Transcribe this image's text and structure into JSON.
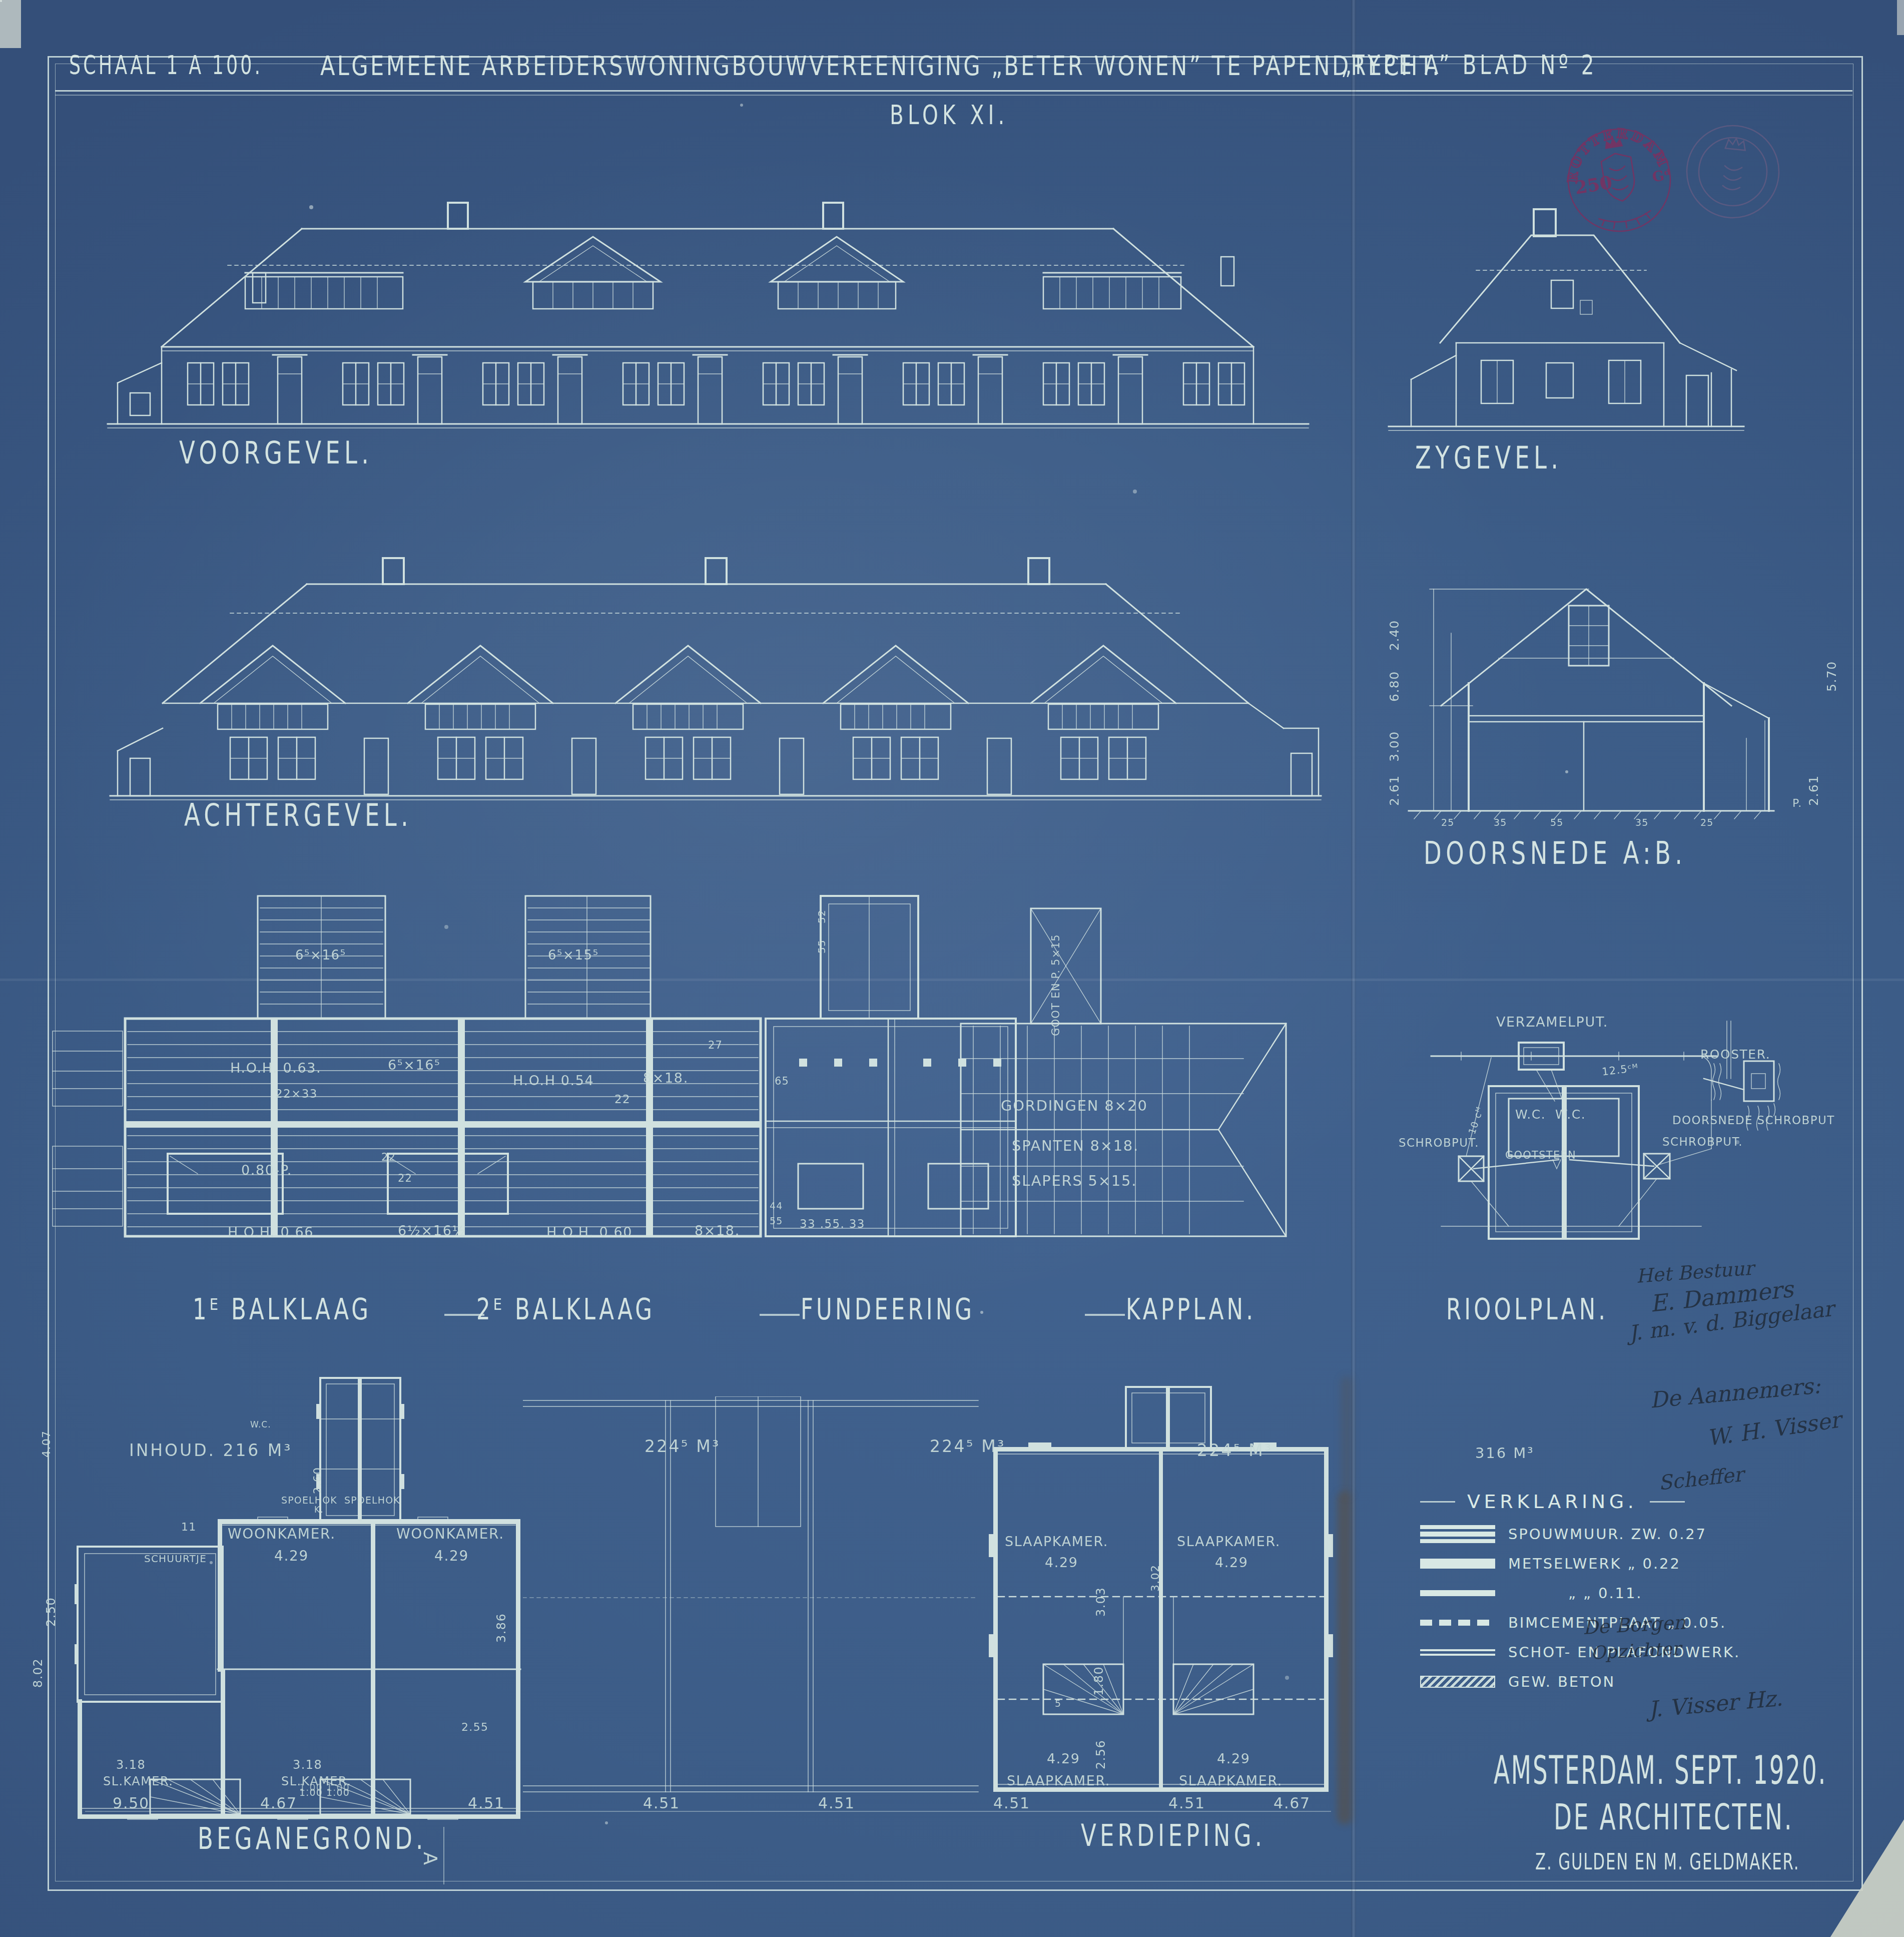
{
  "title": {
    "scale": "SCHAAL 1 A 100.",
    "organization": "ALGEMEENE ARBEIDERSWONINGBOUWVEREENIGING \u201eBETER WONEN\u201d TE PAPENDRECHT.",
    "sheet": "\u201eTYPE A\u201d BLAD N\u00ba 2",
    "block": "BLOK XI."
  },
  "stamp": {
    "city": "ROTTERDAM",
    "value": "250",
    "unit": "G\u1d48"
  },
  "labels": {
    "voorgevel": "VOORGEVEL.",
    "zygevel": "ZYGEVEL.",
    "achtergevel": "ACHTERGEVEL.",
    "doorsnede": "DOORSNEDE A:B.",
    "balklaag1": "1\u1d31 BALKLAAG",
    "balklaag2": "2\u1d31 BALKLAAG",
    "fundeering": "FUNDEERING",
    "kapplan": "KAPPLAN.",
    "rioolplan": "RIOOLPLAN.",
    "beganegrond": "BEGANEGROND.",
    "verdieping": "VERDIEPING.",
    "section_marker": "A"
  },
  "doorsnede": {
    "left_dims": [
      "2.40",
      "6.80",
      "3.00",
      "2.61"
    ],
    "right_dims": [
      "5.70",
      "2.61"
    ],
    "bottom_dims": [
      "25",
      "35",
      "55",
      "35",
      "25"
    ],
    "peil": "P."
  },
  "balklaag": {
    "tower1": "6\u2075\u00d716\u2075",
    "tower2": "6\u2075\u00d715\u2075",
    "hoh1": "H.O.H. 0.63.",
    "beam1": "6\u2075\u00d716\u2075",
    "size1": "22\u00d733",
    "hoh2": "H.O.H 0.54",
    "beam2": "8\u00d718.",
    "n22": "22",
    "opening": "0.80-P.",
    "lintel_a": "22",
    "lintel_b": "22",
    "hoh3": "H.O.H. 0.66",
    "beam3": "6\u00bd\u00d716\u00bd",
    "hoh4": "H.O.H. 0.60",
    "beam4": "8\u00d718."
  },
  "fundeering": {
    "n27": "27",
    "n65": "65",
    "n52": "52",
    "n55": "55",
    "n44": "44",
    "n55b": "55",
    "bottom": "33 .55. 33"
  },
  "kapplan": {
    "gordingen": "GORDINGEN 8\u00d720",
    "spanten": "SPANTEN 8\u00d718.",
    "slapers": "SLAPERS 5\u00d715.",
    "goot": "GOOT EN P. 5\u00d715"
  },
  "rioolplan": {
    "verzamelput": "VERZAMELPUT.",
    "rooster": "ROOSTER.",
    "doorsnede_schrobput": "DOORSNEDE SCHROBPUT",
    "schrobput_left": "SCHROBPUT.",
    "schrobput_right": "SCHROBPUT.",
    "wc1": "W.C.",
    "wc2": "W.C.",
    "gootsteen": "GOOTSTEEN",
    "d125": "12.5\u1d9c\u1d39",
    "d10": "10 c\u1d39"
  },
  "beganegrond": {
    "inhoud": "INHOUD. 216 M\u00b3",
    "woonkamer": "WOONKAMER.",
    "maat_429": "4.29",
    "spoelhok": "SPOELHOK",
    "wc": "W.C.",
    "kast": "K.",
    "schuurtje": "SCHUURTJE",
    "slkamer": "SL.KAMER.",
    "maat_318": "3.18",
    "d11": "11",
    "d260": "2.60",
    "d386": "3.86",
    "d255": "2.55",
    "d250": "2.50",
    "d802": "8.02",
    "d407": "4.07",
    "d100": "1.00"
  },
  "verdieping": {
    "slaapkamer": "SLAAPKAMER.",
    "maat_429": "4.29",
    "d303": "3.03",
    "d180": "1.80",
    "d256": "2.56",
    "d302": "3.02",
    "d5": "5"
  },
  "volumes": {
    "v1": "224\u2075 M\u00b3",
    "v2": "224\u2075 M\u00b3",
    "v3": "224\u2075 M\u00b3",
    "v4": "316 M\u00b3"
  },
  "bottom_dims": [
    "9.50",
    "4.67",
    "1.00",
    "1.00",
    "4.51",
    "4.51",
    "4.51",
    "4.51",
    "4.51",
    "4.67"
  ],
  "legend": {
    "title": "VERKLARING.",
    "items": [
      {
        "label": "SPOUWMUUR. ZW. 0.27"
      },
      {
        "label": "METSELWERK  \u201e  0.22"
      },
      {
        "label": "\u201e    \u201e  0.11."
      },
      {
        "label": "BIMCEMENTPLAAT \u201e 0.05."
      },
      {
        "label": "SCHOT- EN PLAFONDWERK."
      },
      {
        "label": "GEW. BETON"
      }
    ]
  },
  "signatures": {
    "bestuur_heading": "Het Bestuur",
    "sig1": "E. Dammers",
    "sig2": "J. m. v. d. Biggelaar",
    "aannemers_heading": "De Aannemers:",
    "sig3": "W. H. Visser",
    "sig4": "Scheffer",
    "borgen_heading": "De Borgen",
    "opzichter": "Opzichter",
    "sig5": "J. Visser Hz."
  },
  "credits": {
    "city_date": "AMSTERDAM. SEPT. 1920.",
    "architects": "DE ARCHITECTEN.",
    "names": "Z. GULDEN EN M. GELDMAKER."
  }
}
